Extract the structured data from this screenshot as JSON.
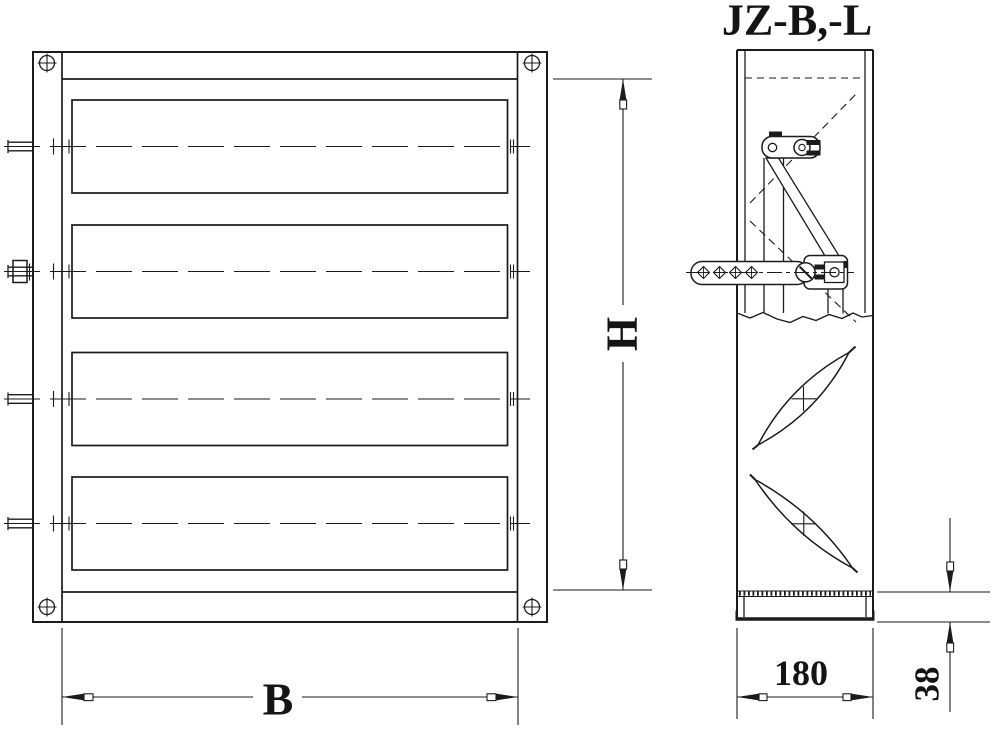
{
  "title": "JZ-B,-L",
  "drawing": {
    "type": "damper-technical-drawing",
    "views": {
      "front": {
        "blade_count": 4,
        "corner_screw_count": 4
      },
      "side": {
        "visible_blade_profiles": 2
      }
    }
  },
  "dimensions": {
    "width": {
      "label": "B"
    },
    "height": {
      "label": "H"
    },
    "depth": {
      "label": "180"
    },
    "base_height": {
      "label": "38"
    }
  },
  "icons": {
    "corner_screw": "circle-with-cross"
  },
  "colors": {
    "line": "#1b1b1b",
    "background": "#ffffff"
  }
}
